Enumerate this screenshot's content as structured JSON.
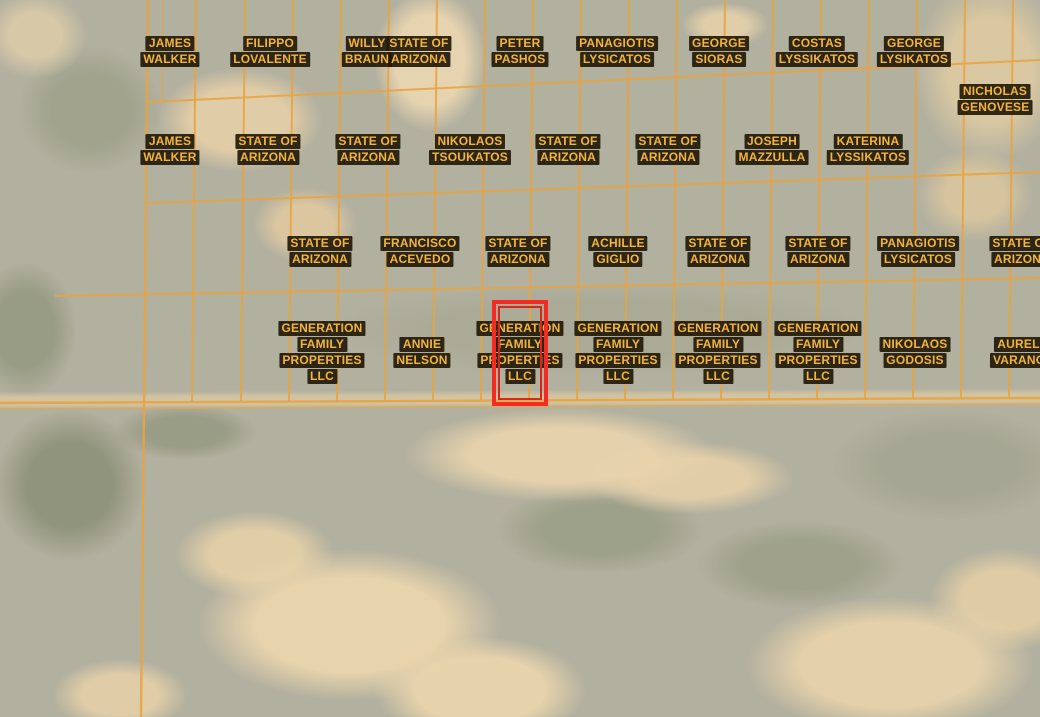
{
  "map": {
    "view": "satellite-parcel-overlay",
    "colors": {
      "grid": "#e9a440",
      "label_text": "#f3b43c",
      "label_background": "#221a0b",
      "highlight_outer": "#f32b22",
      "highlight_inner": "#d6271d"
    },
    "parcels": [
      {
        "lines": [
          "JAMES",
          "WALKER"
        ],
        "x": 170,
        "y": 51
      },
      {
        "lines": [
          "FILIPPO",
          "LOVALENTE"
        ],
        "x": 270,
        "y": 51
      },
      {
        "lines": [
          "WILLY",
          "BRAUN"
        ],
        "x": 367,
        "y": 51
      },
      {
        "lines": [
          "STATE OF",
          "ARIZONA"
        ],
        "x": 419,
        "y": 51
      },
      {
        "lines": [
          "PETER",
          "PASHOS"
        ],
        "x": 520,
        "y": 51
      },
      {
        "lines": [
          "PANAGIOTIS",
          "LYSICATOS"
        ],
        "x": 617,
        "y": 51
      },
      {
        "lines": [
          "GEORGE",
          "SIORAS"
        ],
        "x": 719,
        "y": 51
      },
      {
        "lines": [
          "COSTAS",
          "LYSSIKATOS"
        ],
        "x": 817,
        "y": 51
      },
      {
        "lines": [
          "GEORGE",
          "LYSIKATOS"
        ],
        "x": 914,
        "y": 51
      },
      {
        "lines": [
          "NICHOLAS",
          "GENOVESE"
        ],
        "x": 995,
        "y": 99
      },
      {
        "lines": [
          "JAMES",
          "WALKER"
        ],
        "x": 170,
        "y": 149
      },
      {
        "lines": [
          "STATE OF",
          "ARIZONA"
        ],
        "x": 268,
        "y": 149
      },
      {
        "lines": [
          "STATE OF",
          "ARIZONA"
        ],
        "x": 368,
        "y": 149
      },
      {
        "lines": [
          "NIKOLAOS",
          "TSOUKATOS"
        ],
        "x": 470,
        "y": 149
      },
      {
        "lines": [
          "STATE OF",
          "ARIZONA"
        ],
        "x": 568,
        "y": 149
      },
      {
        "lines": [
          "STATE OF",
          "ARIZONA"
        ],
        "x": 668,
        "y": 149
      },
      {
        "lines": [
          "JOSEPH",
          "MAZZULLA"
        ],
        "x": 772,
        "y": 149
      },
      {
        "lines": [
          "KATERINA",
          "LYSSIKATOS"
        ],
        "x": 868,
        "y": 149
      },
      {
        "lines": [
          "STATE OF",
          "ARIZONA"
        ],
        "x": 320,
        "y": 251
      },
      {
        "lines": [
          "FRANCISCO",
          "ACEVEDO"
        ],
        "x": 420,
        "y": 251
      },
      {
        "lines": [
          "STATE OF",
          "ARIZONA"
        ],
        "x": 518,
        "y": 251
      },
      {
        "lines": [
          "ACHILLE",
          "GIGLIO"
        ],
        "x": 618,
        "y": 251
      },
      {
        "lines": [
          "STATE OF",
          "ARIZONA"
        ],
        "x": 718,
        "y": 251
      },
      {
        "lines": [
          "STATE OF",
          "ARIZONA"
        ],
        "x": 818,
        "y": 251
      },
      {
        "lines": [
          "PANAGIOTIS",
          "LYSICATOS"
        ],
        "x": 918,
        "y": 251
      },
      {
        "lines": [
          "STATE OF",
          "ARIZONA"
        ],
        "x": 1022,
        "y": 251
      },
      {
        "lines": [
          "GENERATION",
          "FAMILY",
          "PROPERTIES",
          "LLC"
        ],
        "x": 322,
        "y": 352
      },
      {
        "lines": [
          "ANNIE",
          "NELSON"
        ],
        "x": 422,
        "y": 352
      },
      {
        "lines": [
          "GENERATION",
          "FAMILY",
          "PROPERTIES",
          "LLC"
        ],
        "x": 520,
        "y": 352,
        "highlighted": true
      },
      {
        "lines": [
          "GENERATION",
          "FAMILY",
          "PROPERTIES",
          "LLC"
        ],
        "x": 618,
        "y": 352
      },
      {
        "lines": [
          "GENERATION",
          "FAMILY",
          "PROPERTIES",
          "LLC"
        ],
        "x": 718,
        "y": 352
      },
      {
        "lines": [
          "GENERATION",
          "FAMILY",
          "PROPERTIES",
          "LLC"
        ],
        "x": 818,
        "y": 352
      },
      {
        "lines": [
          "NIKOLAOS",
          "GODOSIS"
        ],
        "x": 915,
        "y": 352
      },
      {
        "lines": [
          "AURELIO",
          "VARANGIS"
        ],
        "x": 1025,
        "y": 352
      }
    ],
    "highlight": {
      "owner": "GENERATION FAMILY PROPERTIES LLC",
      "x": 492,
      "y": 300,
      "width": 56,
      "height": 106
    }
  }
}
